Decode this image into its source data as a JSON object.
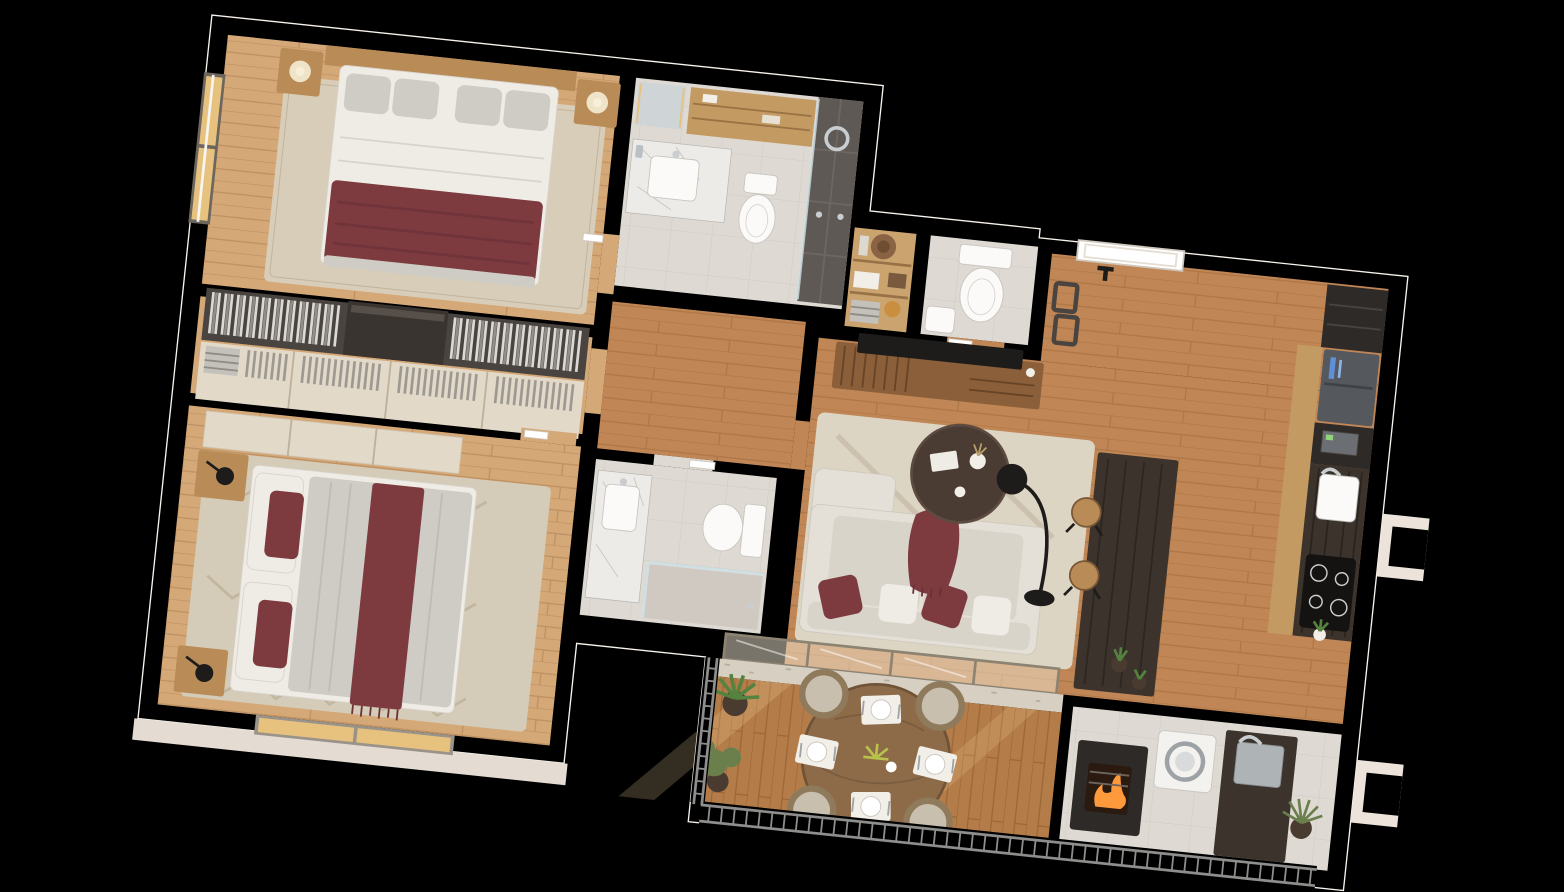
{
  "scene": {
    "title": "3D rendered top-down floor plan of a two-bedroom apartment with balcony",
    "view": "axonometric top-down cutaway",
    "background": "#000000"
  },
  "palette": {
    "bg": "#000000",
    "wall": "#ece4da",
    "wallEdge": "#f8f3ec",
    "slab": "#e4dcd2",
    "woodFloor": "#c08655",
    "woodLight": "#d4a877",
    "deck": "#b47c48",
    "tile": "#dedad3",
    "tileDark": "#cfc9c1",
    "rugLiving": "#ddd5c4",
    "rugMaster": "#d8cdb8",
    "rugBedroom": "#d4cbb8",
    "marble": "#edebe8",
    "marbleVein": "#b9b6b2",
    "darkCabinet": "#2e2a27",
    "darkCounter": "#3b332c",
    "woodCabinet": "#c49a63",
    "woodFurniture": "#b98b57",
    "tvWood": "#8a5f3a",
    "headboard": "#c8a06b",
    "sofa": "#e5e0d7",
    "cushion": "#d9d4ca",
    "linenWhite": "#efece6",
    "linenGray": "#cfccc5",
    "burgundy": "#7d3b40",
    "burgundyDark": "#6a3136",
    "black": "#1d1c1b",
    "chrome": "#c9cdd0",
    "steel": "#aeb3b6",
    "glassFrame": "#8d8372",
    "glassFill": "#f2e8d4",
    "railing": "#8e8e8c",
    "plantGreen": "#55833f",
    "plantOlive": "#6b7f4d",
    "plantPot": "#4a3b30",
    "amber": "#e7c27f",
    "fire": "#ff9a3c",
    "white": "#f4f2ee",
    "shelfWood": "#caa36f",
    "shower": "#5f5955",
    "showerTile": "#6d6763",
    "appliance": "#55585c",
    "blueDisplay": "#5f8fd6",
    "closetDark": "#494440",
    "wardrobeCream": "#e3d9c8"
  },
  "rooms": [
    {
      "id": "master-bedroom",
      "name": "Master Bedroom",
      "furniture": [
        "double bed",
        "wood headboard",
        "gray pillows",
        "burgundy throw blanket",
        "nightstand left",
        "nightstand right",
        "cream table lamps",
        "area rug",
        "window"
      ]
    },
    {
      "id": "ensuite-bathroom",
      "name": "Ensuite Bathroom",
      "furniture": [
        "marble vanity with sink",
        "led mirror",
        "wood shelving",
        "toilet",
        "dark tiled walk-in shower",
        "rain shower head"
      ]
    },
    {
      "id": "walk-in-closet",
      "name": "Walk-in Closet",
      "furniture": [
        "hanging clothes rail left",
        "hanging clothes rail right",
        "dark dresser",
        "cream wardrobe",
        "folded clothes"
      ]
    },
    {
      "id": "bedroom-2",
      "name": "Bedroom 2",
      "furniture": [
        "double bed",
        "burgundy pillows",
        "burgundy runner",
        "nightstands",
        "black table lamps",
        "chevron rug",
        "wardrobe",
        "window"
      ]
    },
    {
      "id": "bathroom-2",
      "name": "Bathroom 2",
      "furniture": [
        "marble vanity with sink",
        "toilet",
        "glass shower enclosure"
      ]
    },
    {
      "id": "hallway",
      "name": "Hallway",
      "furniture": [
        "interior doors"
      ]
    },
    {
      "id": "wc",
      "name": "Guest WC",
      "furniture": [
        "toilet",
        "corner washbasin",
        "storage shelf with hat, vases, boxes and towels"
      ]
    },
    {
      "id": "entry",
      "name": "Entry",
      "furniture": [
        "entry door",
        "wall art frames"
      ]
    },
    {
      "id": "living-room",
      "name": "Living Room",
      "furniture": [
        "tv",
        "wood media console",
        "sofa with burgundy cushions",
        "round coffee table",
        "arc floor lamp",
        "area rug"
      ]
    },
    {
      "id": "kitchen",
      "name": "Kitchen",
      "furniture": [
        "dark wall cabinets",
        "refrigerator with blue display",
        "built-in microwave",
        "white sink",
        "induction cooktop",
        "dark island counter",
        "bar stools",
        "small plants"
      ]
    },
    {
      "id": "laundry-grill",
      "name": "Laundry / Grill Terrace",
      "furniture": [
        "washing machine",
        "dark counter",
        "steel sink",
        "barbecue grill with fire",
        "plant"
      ]
    },
    {
      "id": "balcony",
      "name": "Balcony Terrace",
      "furniture": [
        "round dining table",
        "four place settings",
        "four chairs",
        "potted plants",
        "metal railing",
        "sliding glass doors",
        "stone sill"
      ]
    }
  ]
}
